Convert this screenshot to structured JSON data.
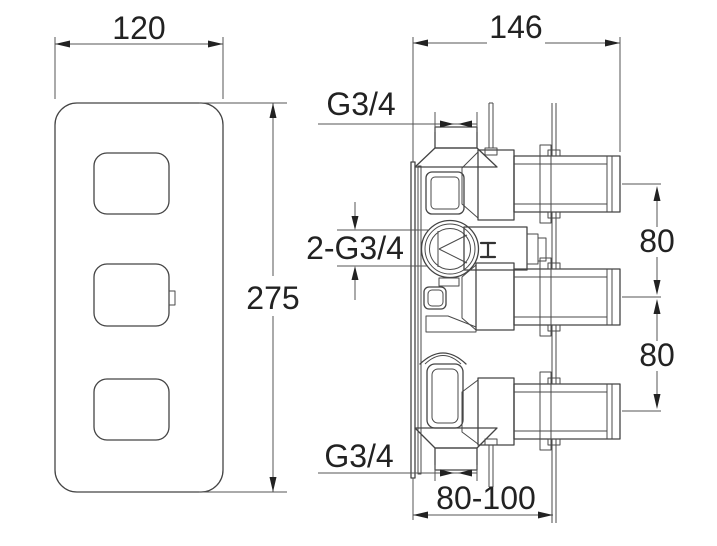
{
  "front_view": {
    "width_label": "120",
    "height_label": "275"
  },
  "side_view": {
    "depth_label": "146",
    "top_port_label": "G3/4",
    "inlet_label": "2-G3/4",
    "upper_spacing_label": "80",
    "lower_spacing_label": "80",
    "bottom_port_label": "G3/4",
    "install_depth_label": "80-100"
  },
  "colors": {
    "background": "#ffffff",
    "line": "#444444",
    "text": "#222222"
  }
}
